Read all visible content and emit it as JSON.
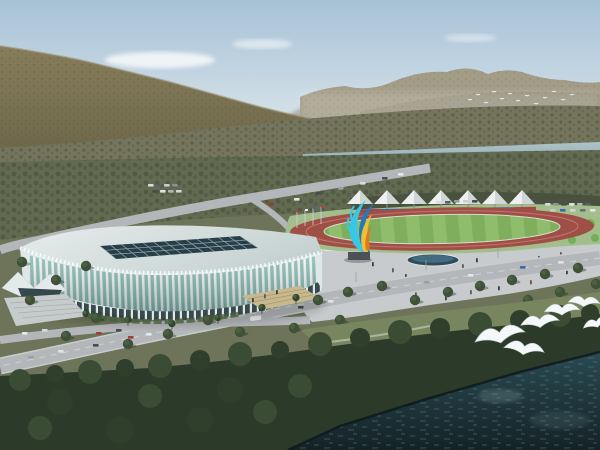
{
  "scene": {
    "description": "Aerial architectural rendering: white lattice-ribbed stadium beside an outdoor running track with rainbow grandstand wall and white canopy tents, landscaped plazas and roads, a river and forested mountains behind, dark water with white gulls in the foreground",
    "elements": [
      "sky",
      "clouds",
      "distant-hills",
      "mountain-range-left",
      "mountain-range-right",
      "distant-bird-flock",
      "hillside-forest",
      "river",
      "forest-belt",
      "access-roads",
      "parking-lots",
      "canopy-tents",
      "rainbow-wall",
      "running-track",
      "infield",
      "flag-poles",
      "ribbon-sculpture",
      "stadium",
      "roof-skylight",
      "entrance-canopy",
      "entrance-stairs",
      "plaza",
      "fountain-pool",
      "pedestrians",
      "street-trees",
      "boulevard",
      "vehicles",
      "lakeside-forest",
      "water",
      "seagulls"
    ]
  },
  "counts": {
    "canopy_tents": 7,
    "rainbow_wall_segments": 7,
    "foreground_seagulls": 6,
    "distant_flock_birds": 13
  },
  "palette": {
    "sky_top": "#a7c2d7",
    "sky_mid": "#cfdde6",
    "sky_horizon": "#e9edee",
    "cloud": "#ffffff",
    "hills_distant": "#a39da3",
    "mountain_far": "#a39c87",
    "mountain_far_shadow": "#8f8a74",
    "mountain_near": "#877d5c",
    "mountain_near_dark": "#6b6648",
    "mountain_texture": "#554f3a",
    "forest_mid": "#75745c",
    "orchard_dot": "#454c38",
    "river": "#adc3c8",
    "river_deep": "#93aeb4",
    "ground": "#6d745a",
    "forest_low": "#636a52",
    "lawn": "#a3bd8d",
    "shrub_bright": "#6fae4f",
    "treeline": "#49523f",
    "tent": "#eef0f0",
    "tent_shade": "#cfd6d6",
    "track": "#9e5047",
    "track_line": "#c77f72",
    "field": "#7fae5c",
    "field_light": "#93c06f",
    "fence": "#eceeec",
    "wall_colors": [
      "#94495a",
      "#3f63a8",
      "#49964e",
      "#c9b176",
      "#4a6fb0",
      "#7a55a0",
      "#a34a44"
    ],
    "stadium_roof": "#e7edec",
    "stadium_roof_dark": "#c6d2d2",
    "stadium_glass": "#7fb0a8",
    "stadium_rib": "#f6fafa",
    "skylight": "#263f49",
    "skylight_grid": "#9fb4b6",
    "arcade_dark": "#2f4246",
    "plaza": "#c7cbcd",
    "pool": "#2e4c5c",
    "pool_light": "#55809a",
    "road": "#b3b7b9",
    "road_dash": "#e8eaea",
    "grass": "#78865f",
    "tree": "#3f5138",
    "tree_dark": "#2f3f2c",
    "canopy_light": "#3a4c34",
    "forest_dark": "#2c3a2a",
    "water_top": "#2a4a52",
    "water_deep": "#142226",
    "ripple": "#6d9097",
    "bird": "#f5f8f8",
    "sculpture_cyan": "#35c8e8",
    "sculpture_blue": "#1f7ac0",
    "sculpture_yellow": "#f0c030",
    "sculpture_orange": "#e07820",
    "pedestal": "#4b5157",
    "stairs_tan": "#c8b88e",
    "stairs_gray": "#c6cbcb"
  }
}
